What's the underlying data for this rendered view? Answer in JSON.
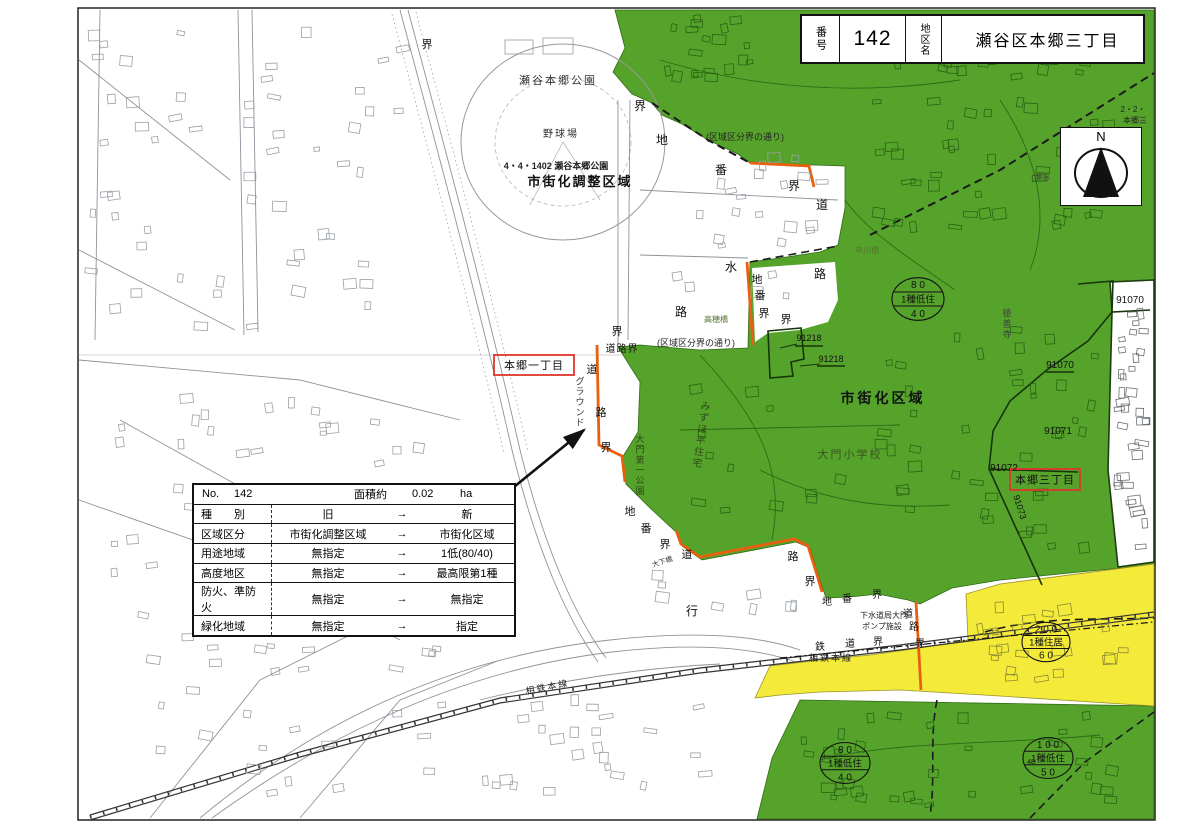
{
  "title_box": {
    "no_label": "番号",
    "no_value": "142",
    "name_label": "地区名",
    "name_value": "瀬谷区本郷三丁目"
  },
  "compass": {
    "label": "N"
  },
  "info_table": {
    "no_label": "No.",
    "no_value": "142",
    "area_label": "面積約",
    "area_value": "0.02",
    "area_unit": "ha",
    "arrow": "→",
    "rows": [
      {
        "label": "種　　別",
        "old": "旧",
        "new": "新"
      },
      {
        "label": "区域区分",
        "old": "市街化調整区域",
        "new": "市街化区域"
      },
      {
        "label": "用途地域",
        "old": "無指定",
        "new": "1低(80/40)"
      },
      {
        "label": "高度地区",
        "old": "無指定",
        "new": "最高限第1種"
      },
      {
        "label": "防火、準防火",
        "old": "無指定",
        "new": "無指定"
      },
      {
        "label": "緑化地域",
        "old": "無指定",
        "new": "指定"
      }
    ]
  },
  "map": {
    "labels": [
      {
        "t": "瀬谷本郷公園",
        "x": 558,
        "y": 84,
        "s": 11,
        "c": "#333",
        "ls": 2
      },
      {
        "t": "野球場",
        "x": 561,
        "y": 137,
        "s": 10,
        "c": "#333",
        "ls": 2
      },
      {
        "t": "4・4・1402 瀬谷本郷公園",
        "x": 556,
        "y": 169,
        "s": 9,
        "b": 1,
        "c": "#222"
      },
      {
        "t": "市街化調整区域",
        "x": 580,
        "y": 186,
        "s": 13,
        "b": 1,
        "c": "#111",
        "ls": 2
      },
      {
        "t": "市街化区域",
        "x": 883,
        "y": 403,
        "s": 14,
        "b": 1,
        "c": "#111",
        "ls": 3
      },
      {
        "t": "大門小学校",
        "x": 850,
        "y": 458,
        "s": 11,
        "c": "#38531f",
        "ls": 2
      },
      {
        "t": "みずほ平住宅",
        "x": 701,
        "y": 438,
        "s": 10,
        "c": "#2c4a16",
        "v": 1,
        "r": 8
      },
      {
        "t": "大門第一公園",
        "x": 640,
        "y": 468,
        "s": 9,
        "c": "#2c4a16",
        "v": 1
      },
      {
        "t": "(区域区分界の通り)",
        "x": 745,
        "y": 140,
        "s": 9,
        "c": "#222"
      },
      {
        "t": "(区域区分界の通り)",
        "x": 696,
        "y": 346,
        "s": 9,
        "c": "#222"
      },
      {
        "t": "高穂橋",
        "x": 716,
        "y": 322,
        "s": 8,
        "c": "#55702f"
      },
      {
        "t": "中川橋",
        "x": 867,
        "y": 253,
        "s": 8,
        "c": "#55702f"
      },
      {
        "t": "徳善寺",
        "x": 1007,
        "y": 327,
        "s": 9,
        "c": "#3c3c3c",
        "v": 1
      },
      {
        "t": "瀬谷",
        "x": 1042,
        "y": 180,
        "s": 8,
        "c": "#444"
      },
      {
        "t": "2・2・",
        "x": 1133,
        "y": 112,
        "s": 8,
        "c": "#222"
      },
      {
        "t": "本郷三",
        "x": 1135,
        "y": 123,
        "s": 8,
        "c": "#222"
      },
      {
        "t": "91070",
        "x": 1130,
        "y": 303,
        "s": 10,
        "c": "#111"
      },
      {
        "t": "91070",
        "x": 1060,
        "y": 368,
        "s": 10,
        "c": "#111"
      },
      {
        "t": "91071",
        "x": 1058,
        "y": 434,
        "s": 10,
        "c": "#111"
      },
      {
        "t": "91072",
        "x": 1004,
        "y": 471,
        "s": 10,
        "c": "#111"
      },
      {
        "t": "91073",
        "x": 1017,
        "y": 508,
        "s": 9,
        "c": "#111",
        "r": 72
      },
      {
        "t": "91218",
        "x": 809,
        "y": 341,
        "s": 9,
        "c": "#111"
      },
      {
        "t": "91218",
        "x": 831,
        "y": 362,
        "s": 9,
        "c": "#111"
      },
      {
        "t": "界",
        "x": 427,
        "y": 48,
        "s": 11,
        "c": "#111"
      },
      {
        "t": "界",
        "x": 640,
        "y": 110,
        "s": 12,
        "c": "#111"
      },
      {
        "t": "地",
        "x": 662,
        "y": 144,
        "s": 12,
        "c": "#111"
      },
      {
        "t": "番",
        "x": 721,
        "y": 174,
        "s": 12,
        "c": "#111"
      },
      {
        "t": "界",
        "x": 794,
        "y": 190,
        "s": 12,
        "c": "#111"
      },
      {
        "t": "道",
        "x": 822,
        "y": 209,
        "s": 12,
        "c": "#111"
      },
      {
        "t": "水",
        "x": 731,
        "y": 271,
        "s": 12,
        "c": "#111"
      },
      {
        "t": "路",
        "x": 820,
        "y": 278,
        "s": 12,
        "c": "#111"
      },
      {
        "t": "路",
        "x": 681,
        "y": 316,
        "s": 12,
        "c": "#111"
      },
      {
        "t": "地",
        "x": 757,
        "y": 283,
        "s": 11,
        "c": "#111"
      },
      {
        "t": "番",
        "x": 760,
        "y": 299,
        "s": 11,
        "c": "#111"
      },
      {
        "t": "界",
        "x": 764,
        "y": 317,
        "s": 11,
        "c": "#111"
      },
      {
        "t": "界",
        "x": 786,
        "y": 323,
        "s": 11,
        "c": "#111"
      },
      {
        "t": "道路界",
        "x": 622,
        "y": 352,
        "s": 10,
        "c": "#111",
        "ls": 1
      },
      {
        "t": "界",
        "x": 617,
        "y": 335,
        "s": 11,
        "c": "#111"
      },
      {
        "t": "道",
        "x": 592,
        "y": 373,
        "s": 11,
        "c": "#111"
      },
      {
        "t": "路",
        "x": 601,
        "y": 416,
        "s": 11,
        "c": "#111"
      },
      {
        "t": "界",
        "x": 606,
        "y": 451,
        "s": 11,
        "c": "#111"
      },
      {
        "t": "グラウンド",
        "x": 580,
        "y": 405,
        "s": 9,
        "c": "#333",
        "v": 1
      },
      {
        "t": "地",
        "x": 630,
        "y": 515,
        "s": 11,
        "c": "#111"
      },
      {
        "t": "番",
        "x": 646,
        "y": 532,
        "s": 11,
        "c": "#111"
      },
      {
        "t": "界",
        "x": 665,
        "y": 548,
        "s": 11,
        "c": "#111"
      },
      {
        "t": "道",
        "x": 687,
        "y": 558,
        "s": 11,
        "c": "#111"
      },
      {
        "t": "大下橋",
        "x": 663,
        "y": 564,
        "s": 7,
        "c": "#333",
        "r": -18
      },
      {
        "t": "行",
        "x": 692,
        "y": 615,
        "s": 12,
        "c": "#111"
      },
      {
        "t": "路",
        "x": 793,
        "y": 560,
        "s": 11,
        "c": "#111"
      },
      {
        "t": "界",
        "x": 810,
        "y": 585,
        "s": 11,
        "c": "#111"
      },
      {
        "t": "地",
        "x": 827,
        "y": 605,
        "s": 10,
        "c": "#111"
      },
      {
        "t": "番",
        "x": 847,
        "y": 602,
        "s": 10,
        "c": "#111"
      },
      {
        "t": "界",
        "x": 877,
        "y": 598,
        "s": 10,
        "c": "#111"
      },
      {
        "t": "下水道局大門",
        "x": 884,
        "y": 618,
        "s": 8,
        "c": "#222"
      },
      {
        "t": "ポンプ施設",
        "x": 882,
        "y": 629,
        "s": 8,
        "c": "#222"
      },
      {
        "t": "道",
        "x": 908,
        "y": 617,
        "s": 10,
        "c": "#111"
      },
      {
        "t": "路",
        "x": 914,
        "y": 630,
        "s": 10,
        "c": "#111"
      },
      {
        "t": "界",
        "x": 920,
        "y": 647,
        "s": 10,
        "c": "#111"
      },
      {
        "t": "鉄",
        "x": 820,
        "y": 650,
        "s": 10,
        "c": "#111"
      },
      {
        "t": "道",
        "x": 850,
        "y": 647,
        "s": 10,
        "c": "#111"
      },
      {
        "t": "界",
        "x": 878,
        "y": 645,
        "s": 10,
        "c": "#111"
      },
      {
        "t": "相鉄本線",
        "x": 831,
        "y": 661,
        "s": 9,
        "c": "#222",
        "ls": 2
      },
      {
        "t": "相鉄本線",
        "x": 548,
        "y": 690,
        "s": 9,
        "c": "#222",
        "r": -11,
        "ls": 2
      },
      {
        "t": "48",
        "x": 1031,
        "y": 764,
        "s": 7,
        "c": "#111"
      }
    ],
    "zone_circles": [
      {
        "cx": 918,
        "cy": 299,
        "r": 26,
        "lines": [
          "8 0",
          "1種低住",
          "4 0"
        ]
      },
      {
        "cx": 1046,
        "cy": 642,
        "r": 24,
        "lines": [
          "2 0 0",
          "1種住居",
          "6 0"
        ]
      },
      {
        "cx": 845,
        "cy": 763,
        "r": 25,
        "lines": [
          "8 0",
          "1種低住",
          "4 0"
        ]
      },
      {
        "cx": 1048,
        "cy": 758,
        "r": 25,
        "lines": [
          "1 0 0",
          "1種低住",
          "5 0"
        ]
      }
    ],
    "red_boxes": [
      {
        "x": 494,
        "y": 355,
        "w": 80,
        "h": 20,
        "text": "本郷一丁目"
      },
      {
        "x": 1010,
        "y": 469,
        "w": 70,
        "h": 21,
        "text": "本郷三丁目"
      }
    ]
  },
  "colors": {
    "green": "#56a32c",
    "green_line": "#2a6312",
    "yellow": "#f4ea3a",
    "orange": "#e8600f",
    "red": "#df352c",
    "sheet_border": "#222"
  }
}
